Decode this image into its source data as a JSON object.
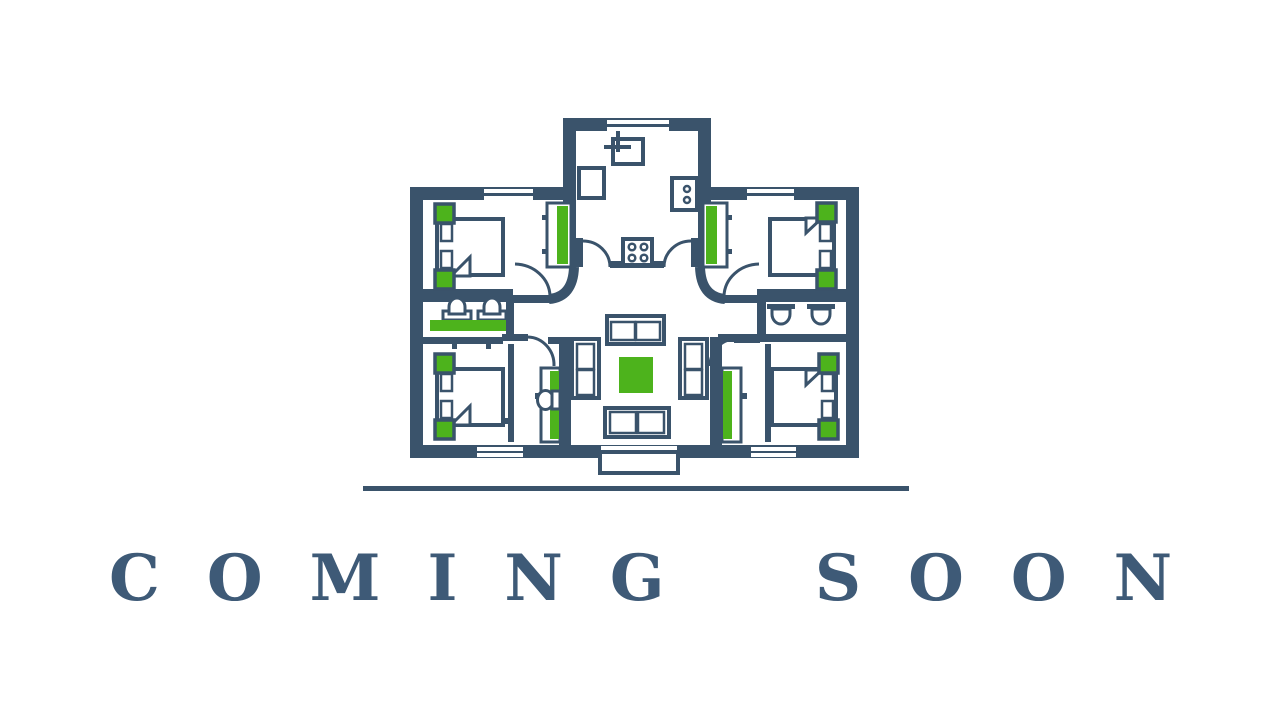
{
  "caption": {
    "text": "COMING SOON"
  },
  "colors": {
    "wall": "#3a536b",
    "accent": "#4db31c",
    "caption": "#3e5a77",
    "bg": "#ffffff"
  },
  "floorplan": {
    "alt": "four-bedroom house floor plan illustration",
    "elements": [
      "kitchen-sink-icon",
      "stove-icon",
      "fridge-icon",
      "counter-icon",
      "bed-icon",
      "pillow-icon",
      "blanket-fold-icon",
      "nightstand-icon",
      "wardrobe-icon",
      "bathroom-sink-icon",
      "toilet-icon",
      "vanity-icon",
      "sofa-icon",
      "armchair-icon",
      "rug-icon",
      "window-icon",
      "door-arc-icon",
      "entrance-step-icon"
    ]
  }
}
